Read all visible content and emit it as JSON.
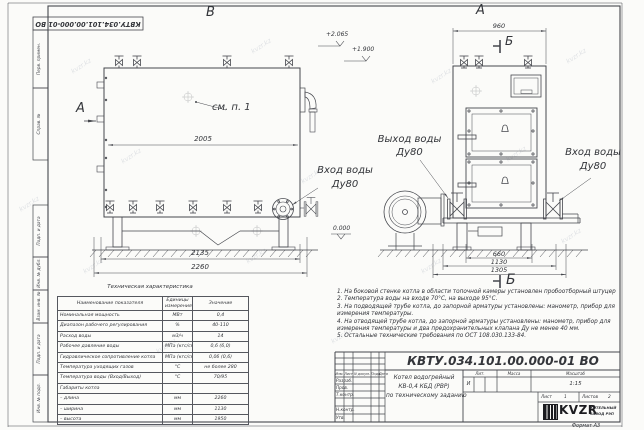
{
  "sheet": {
    "doc_number": "КВТУ.034.101.00.000-01 ВО",
    "doc_number_rotated": "КВТУ.034.101.00.000-01 ВО",
    "format": "Формат  А3",
    "watermark": "kvzr.kz"
  },
  "frame_strip": {
    "items": [
      "Перв. примен.",
      "Справ. №",
      "Подп. и дата",
      "Инв. № дубл.",
      "Взам. инв. №",
      "Подп. и дата",
      "Инв. № подл."
    ]
  },
  "views": {
    "label_b": "В",
    "label_a": "А",
    "label_a_arrow": "А",
    "section_top": "Б",
    "section_bottom": "Б",
    "callout_see_item": "см. п. 1",
    "outlet_line1": "Выход воды",
    "outlet_line2": "Ду80",
    "inlet_left_line1": "Вход воды",
    "inlet_left_line2": "Ду80",
    "inlet_right_line1": "Вход воды",
    "inlet_right_line2": "Ду80"
  },
  "dims": {
    "b_top": "2005",
    "b_mid": "2135",
    "b_total": "2260",
    "a_top": "960",
    "a_b1": "660",
    "a_b2": "1130",
    "a_b3": "1305",
    "elev_a": "+2.065",
    "elev_b": "+1.900",
    "elev_zero": "0.000"
  },
  "spec_table": {
    "title": "Техническая характеристика",
    "col_name": "Наименование показателя",
    "col_units_1": "Единицы",
    "col_units_2": "измерения",
    "col_value": "Значение",
    "rows": [
      {
        "name": "Номинальная мощность",
        "units": "МВт",
        "value": "0,4"
      },
      {
        "name": "Диапазон рабочего регулирования",
        "units": "%",
        "value": "40-110"
      },
      {
        "name": "Расход воды",
        "units": "м3/ч",
        "value": "14"
      },
      {
        "name": "Рабочее давление воды",
        "units": "МПа (кгс/см2)",
        "value": "0,6 (6,0)"
      },
      {
        "name": "Гидравлическое сопротивление котла",
        "units": "МПа (кгс/см2)",
        "value": "0,06 (0,6)"
      },
      {
        "name": "Температура уходящих газов",
        "units": "°С",
        "value": "не более 280"
      },
      {
        "name": "Температура воды (Вход/Выход)",
        "units": "°С",
        "value": "70/95"
      },
      {
        "name": "Габариты котла",
        "units": "",
        "value": ""
      },
      {
        "name": "– длина",
        "units": "мм",
        "value": "2260"
      },
      {
        "name": "– ширина",
        "units": "мм",
        "value": "1130"
      },
      {
        "name": "– высота",
        "units": "мм",
        "value": "1950"
      }
    ]
  },
  "notes": {
    "items": [
      "1. На боковой стенке котла в области топочной камеры установлен пробоотборный штуцер",
      "2. Температура воды на входе 70°С, на выходе 95°С.",
      "3. На подводящей трубе котла, до запорной арматуры установлены: манометр, прибор для измерения температуры.",
      "4. На отводящей трубе котла, до запорной арматуры установлены: манометр, прибор для измерения температуры и два предохранительных клапана Ду не менее 40 мм.",
      "5. Остальные технические требования по ОСТ 108.030.133-84."
    ]
  },
  "title_block": {
    "rev_headers": [
      "Изм.",
      "Лист",
      "N докум.",
      "Подп.",
      "Дата"
    ],
    "rev_rows": [
      "Разраб.",
      "Пров.",
      "Т.контр.",
      "Н.контр.",
      "Утв."
    ],
    "product_title_1": "Котел водогрейный",
    "product_title_2": "КВ-0,4  КБД  (РВР)",
    "product_title_3": "по техническому заданию",
    "lit_header": "Лит.",
    "mass_header": "Масса",
    "scale_header": "Масштаб",
    "lit_value": "И",
    "scale_value": "1:15",
    "sheet_label": "Лист",
    "sheet_value": "1",
    "sheets_label": "Листов",
    "sheets_value": "2",
    "logo_text": "KVZR",
    "org_line_1": "КОТЕЛЬНЫЙ",
    "org_line_2": "ЗАВОД РЭП"
  }
}
